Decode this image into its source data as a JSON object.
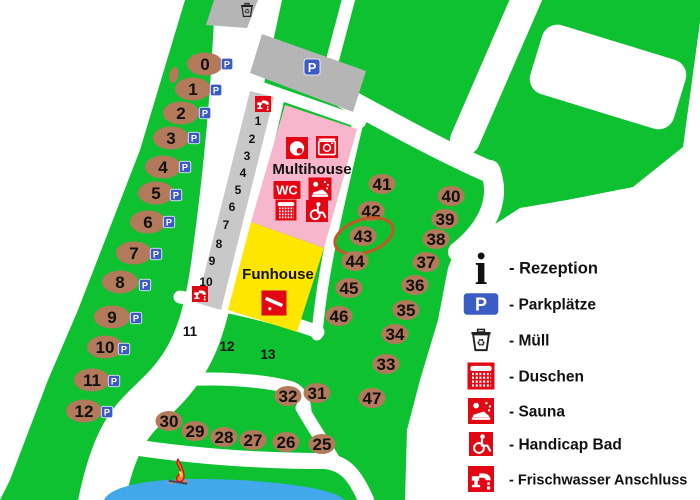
{
  "map": {
    "labels": {
      "multihouse": "Multihouse",
      "funhouse": "Funhouse",
      "wc": "WC",
      "parking_badge": "P",
      "info_glyph": "i",
      "recycle_glyph": "♻"
    },
    "colors": {
      "grass": "#0EC130",
      "road": "#FFFFFF",
      "gray_area": "#B5B5B5",
      "lane_gray": "#C8C8C8",
      "pink": "#F7B6CB",
      "yellow": "#FFE600",
      "water": "#41A8EA",
      "pitch_brown": "#B27A5B",
      "icon_red": "#E30613",
      "parking_blue": "#3B5CC4",
      "highlight_ring": "#BD5B2A"
    },
    "highlighted_pitch": "43",
    "pitches_left": [
      {
        "n": "0",
        "x": 205,
        "y": 64,
        "px": 227,
        "py": 64
      },
      {
        "n": "1",
        "x": 193,
        "y": 89,
        "px": 216,
        "py": 90
      },
      {
        "n": "2",
        "x": 181,
        "y": 113,
        "px": 205,
        "py": 113
      },
      {
        "n": "3",
        "x": 171,
        "y": 138,
        "px": 194,
        "py": 138
      },
      {
        "n": "4",
        "x": 163,
        "y": 167,
        "px": 185,
        "py": 167
      },
      {
        "n": "5",
        "x": 156,
        "y": 193,
        "px": 176,
        "py": 195
      },
      {
        "n": "6",
        "x": 148,
        "y": 222,
        "px": 169,
        "py": 222
      },
      {
        "n": "7",
        "x": 134,
        "y": 253,
        "px": 156,
        "py": 254
      },
      {
        "n": "8",
        "x": 120,
        "y": 282,
        "px": 145,
        "py": 285
      },
      {
        "n": "9",
        "x": 112,
        "y": 317,
        "px": 136,
        "py": 318
      },
      {
        "n": "10",
        "x": 105,
        "y": 347,
        "px": 124,
        "py": 349
      },
      {
        "n": "11",
        "x": 92,
        "y": 380,
        "px": 114,
        "py": 381
      },
      {
        "n": "12",
        "x": 84,
        "y": 411,
        "px": 107,
        "py": 412
      }
    ],
    "pitches_right": [
      {
        "n": "41",
        "x": 382,
        "y": 184
      },
      {
        "n": "42",
        "x": 371,
        "y": 211
      },
      {
        "n": "43",
        "x": 363,
        "y": 236
      },
      {
        "n": "44",
        "x": 355,
        "y": 261
      },
      {
        "n": "45",
        "x": 349,
        "y": 288
      },
      {
        "n": "46",
        "x": 339,
        "y": 316
      },
      {
        "n": "40",
        "x": 451,
        "y": 196
      },
      {
        "n": "39",
        "x": 445,
        "y": 219
      },
      {
        "n": "38",
        "x": 436,
        "y": 239
      },
      {
        "n": "37",
        "x": 426,
        "y": 262
      },
      {
        "n": "36",
        "x": 415,
        "y": 285
      },
      {
        "n": "35",
        "x": 406,
        "y": 310
      },
      {
        "n": "34",
        "x": 395,
        "y": 334
      },
      {
        "n": "33",
        "x": 386,
        "y": 364
      },
      {
        "n": "47",
        "x": 372,
        "y": 398
      },
      {
        "n": "32",
        "x": 288,
        "y": 396
      },
      {
        "n": "31",
        "x": 317,
        "y": 393
      },
      {
        "n": "30",
        "x": 169,
        "y": 421
      },
      {
        "n": "29",
        "x": 195,
        "y": 431
      },
      {
        "n": "28",
        "x": 224,
        "y": 437
      },
      {
        "n": "27",
        "x": 253,
        "y": 440
      },
      {
        "n": "26",
        "x": 286,
        "y": 442
      },
      {
        "n": "25",
        "x": 322,
        "y": 444
      }
    ],
    "lane_numbers": [
      {
        "n": "1",
        "x": 258,
        "y": 121
      },
      {
        "n": "2",
        "x": 252,
        "y": 139
      },
      {
        "n": "3",
        "x": 247,
        "y": 156
      },
      {
        "n": "4",
        "x": 243,
        "y": 173
      },
      {
        "n": "5",
        "x": 238,
        "y": 190
      },
      {
        "n": "6",
        "x": 232,
        "y": 207
      },
      {
        "n": "7",
        "x": 226,
        "y": 225
      },
      {
        "n": "8",
        "x": 219,
        "y": 244
      },
      {
        "n": "9",
        "x": 212,
        "y": 261
      },
      {
        "n": "10",
        "x": 206,
        "y": 282
      }
    ],
    "island_labels": [
      {
        "n": "11",
        "x": 190,
        "y": 331
      },
      {
        "n": "12",
        "x": 227,
        "y": 346
      },
      {
        "n": "13",
        "x": 268,
        "y": 354
      }
    ],
    "multihouse_icons": [
      {
        "name": "washing-machine-icon",
        "sym": "washer1",
        "cx": 297,
        "cy": 148,
        "w": 22,
        "h": 22
      },
      {
        "name": "washer-dryer-icon",
        "sym": "washer2",
        "cx": 327,
        "cy": 147,
        "w": 24,
        "h": 22
      },
      {
        "name": "wc-icon",
        "label": "WC",
        "cx": 287,
        "cy": 190,
        "w": 27,
        "h": 18
      },
      {
        "name": "sauna-icon",
        "sym": "sauna",
        "cx": 320,
        "cy": 189,
        "w": 26,
        "h": 23
      },
      {
        "name": "shower-icon",
        "sym": "shower",
        "cx": 286,
        "cy": 210,
        "w": 26,
        "h": 21
      },
      {
        "name": "handicap-icon",
        "sym": "wheelchair",
        "cx": 317,
        "cy": 211,
        "w": 26,
        "h": 22
      }
    ],
    "funhouse_icon": {
      "name": "slide-icon",
      "sym": "slide",
      "cx": 274,
      "cy": 303,
      "w": 27,
      "h": 25
    },
    "faucet_markers": [
      {
        "cx": 263,
        "cy": 104
      },
      {
        "cx": 200,
        "cy": 294
      }
    ],
    "trash_marker": {
      "cx": 247,
      "cy": 10,
      "s": 17
    },
    "parking_lot_badge": {
      "cx": 312,
      "cy": 67,
      "s": 16
    }
  },
  "legend": {
    "items": [
      {
        "icon": "info-icon",
        "type": "info",
        "label": "- Rezeption",
        "y": 268,
        "size": 16.5
      },
      {
        "icon": "parking-icon",
        "type": "parking",
        "label": "- Parkplätze",
        "y": 304,
        "size": 15.5
      },
      {
        "icon": "trash-icon",
        "type": "trash",
        "label": "- Müll",
        "y": 340,
        "size": 15.5
      },
      {
        "icon": "shower-icon",
        "type": "shower",
        "label": "- Duschen",
        "y": 376,
        "size": 15.5
      },
      {
        "icon": "sauna-icon",
        "type": "sauna",
        "label": "- Sauna",
        "y": 411,
        "size": 15.5
      },
      {
        "icon": "handicap-icon",
        "type": "wheelchair",
        "label": "- Handicap Bad",
        "y": 444,
        "size": 15.5
      },
      {
        "icon": "faucet-icon",
        "type": "faucet",
        "label": "- Frischwasser Anschluss",
        "y": 479,
        "size": 14.5
      }
    ],
    "icon_x": 481,
    "label_x": 509
  }
}
